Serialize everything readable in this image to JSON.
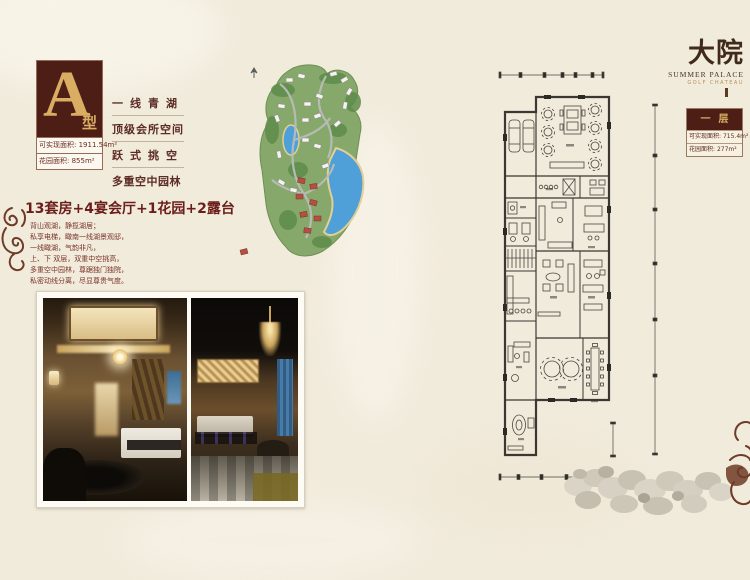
{
  "colors": {
    "maroon": "#4d1e16",
    "gold": "#d9ae62",
    "headline": "#6b1d1a",
    "body_text": "#7a332a",
    "plan_line": "#3b3733",
    "land_green": "#86a96b",
    "lake_blue": "#4fa0d8",
    "red_building": "#b44f42"
  },
  "left": {
    "badge": {
      "letter": "A",
      "suffix": "型"
    },
    "badge_areas": [
      {
        "label": "可实现面积:",
        "value": "1911.54m²"
      },
      {
        "label": "花园面积:",
        "value": "855m²"
      }
    ],
    "taglines": [
      "一线青湖",
      "顶级会所空间",
      "跃式挑空",
      "多重空中园林"
    ],
    "headline": "13套房+4宴会厅+1花园+2露台",
    "description_lines": [
      "背山观湖，静揽湖居；",
      "私享电梯，瞰南一线湖景观邸，",
      "一线瞰湖，气韵非凡，",
      "上、下 双层，双重中空挑高，",
      "多重空中园林，尊踞独门独院，",
      "私密动线分离，尽显尊贵气度。"
    ]
  },
  "right": {
    "brand": {
      "name": "大院",
      "subtitle": "SUMMER PALACE",
      "tagline": "GOLF CHATEAU"
    },
    "floor_badge": {
      "title": "一层",
      "areas": [
        {
          "label": "可实现面积:",
          "value": "715.4m²"
        },
        {
          "label": "花园面积:",
          "value": "277m²"
        }
      ]
    }
  }
}
